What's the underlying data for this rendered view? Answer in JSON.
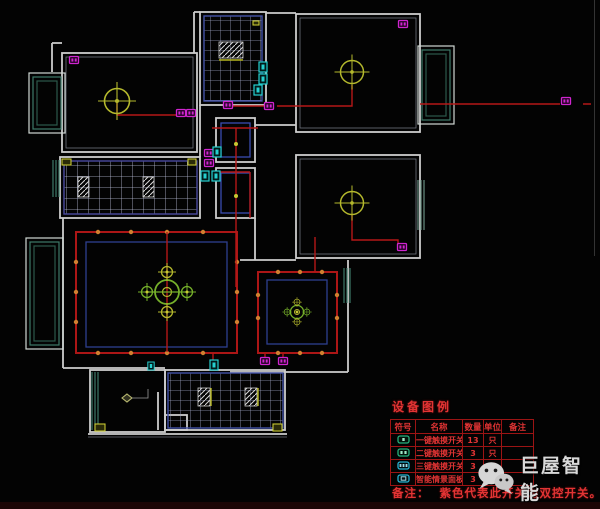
{
  "meta": {
    "description": "CAD smart-home ceiling / lighting electrical plan on black background",
    "width_px": 600,
    "height_px": 509
  },
  "palette": {
    "background": "#030303",
    "wall": "#cdcdcd",
    "window_teal": "#3d7a68",
    "grid_line": "#9aa0c0",
    "grid_border": "#4352a8",
    "ceiling_border_navy": "#2e3f8f",
    "wire_red": "#b51818",
    "cove_red": "#ac1616",
    "spotlight_orange": "#d08030",
    "lamp_yellow": "#b5b92d",
    "chandelier_green": "#76b02a",
    "switch_magenta": "#cf25cf",
    "panel_cyan": "#25cfcf",
    "mark_yellow": "#c8c832",
    "legend_red": "#e23434",
    "watermark_gray": "#d9d9d9"
  },
  "symbols": {
    "ceiling_lamp_count": 3,
    "chandelier_count": 2,
    "touch_switch_color": "magenta",
    "smart_panel_color": "cyan"
  },
  "legend": {
    "title": "设备图例",
    "columns": [
      "符号",
      "名称",
      "数量",
      "单位",
      "备注"
    ],
    "rows": [
      {
        "icon": "one-key-touch-switch-icon",
        "name": "一键触摸开关",
        "qty": "13",
        "unit": "只",
        "remark": ""
      },
      {
        "icon": "two-key-touch-switch-icon",
        "name": "二键触摸开关",
        "qty": "3",
        "unit": "只",
        "remark": ""
      },
      {
        "icon": "three-key-touch-switch-icon",
        "name": "三键触摸开关",
        "qty": "3",
        "unit": "只",
        "remark": ""
      },
      {
        "icon": "smart-scene-panel-icon",
        "name": "智能情景面板",
        "qty": "3",
        "unit": "",
        "remark": ""
      }
    ],
    "note_label": "备注：",
    "note_text": "紫色代表此开关为双控开关。"
  },
  "watermark": {
    "logo": "wechat-logo",
    "text": "巨屋智能"
  }
}
